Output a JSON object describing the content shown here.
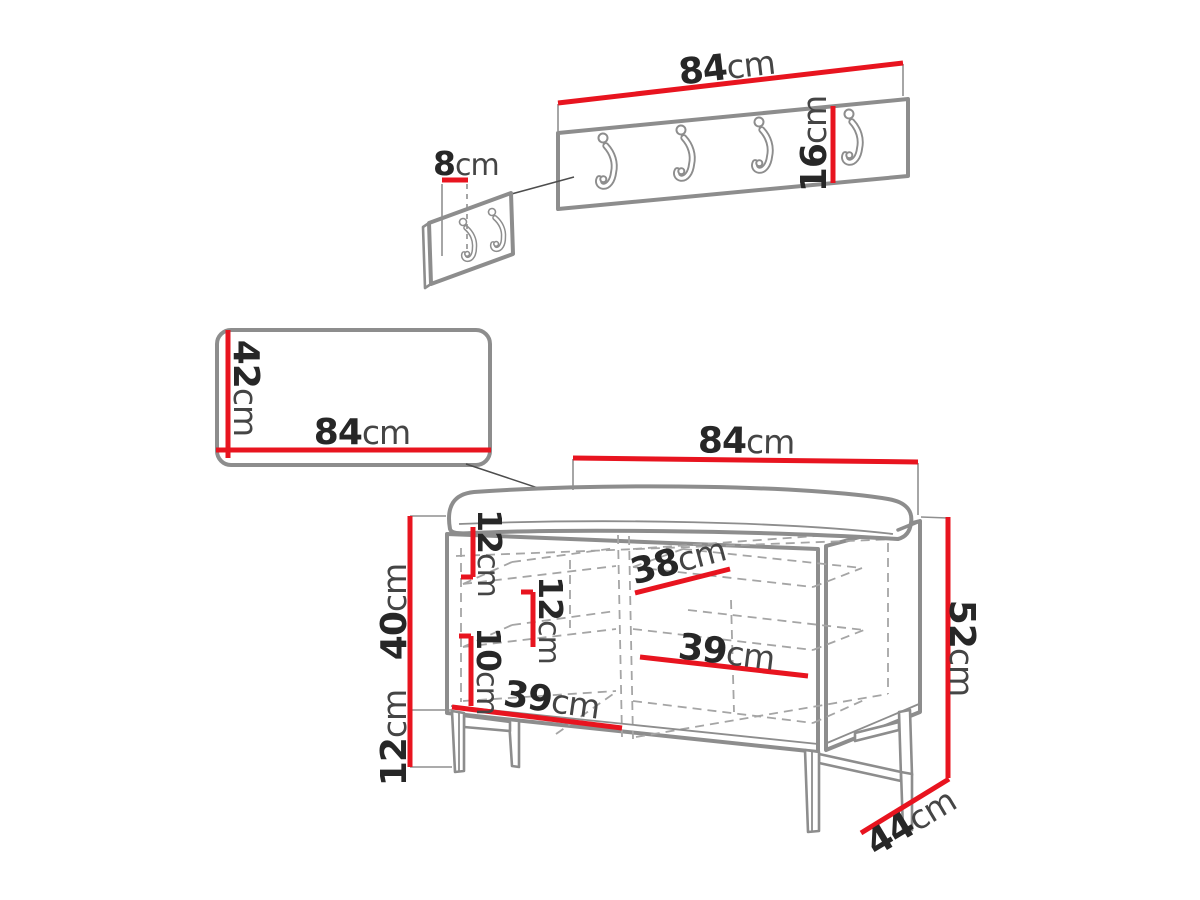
{
  "diagram": {
    "title": "Hallway furniture set dimension drawing",
    "unit": "cm",
    "accent_color": "#e8141f",
    "outline_color": "#8d8d8d",
    "components": {
      "coat_rack": {
        "name": "wall-mounted coat rack panel",
        "hooks_count": 4,
        "width": {
          "value": "84",
          "unit": "cm"
        },
        "height": {
          "value": "16",
          "unit": "cm"
        }
      },
      "hook_detail": {
        "name": "hook spacing detail panel",
        "hooks_count": 2,
        "spacing": {
          "value": "8",
          "unit": "cm"
        }
      },
      "mirror": {
        "name": "wall panel / mirror",
        "height": {
          "value": "42",
          "unit": "cm"
        },
        "width": {
          "value": "84",
          "unit": "cm"
        }
      },
      "bench": {
        "name": "shoe storage bench with cushion",
        "width": {
          "value": "84",
          "unit": "cm"
        },
        "height": {
          "value": "52",
          "unit": "cm"
        },
        "depth": {
          "value": "44",
          "unit": "cm"
        },
        "body_height": {
          "value": "40",
          "unit": "cm"
        },
        "leg_height": {
          "value": "12",
          "unit": "cm"
        },
        "top_gap": {
          "value": "12",
          "unit": "cm"
        },
        "mid_gap": {
          "value": "12",
          "unit": "cm"
        },
        "low_gap": {
          "value": "10",
          "unit": "cm"
        },
        "shelf_top": {
          "value": "38",
          "unit": "cm"
        },
        "shelf_mid": {
          "value": "39",
          "unit": "cm"
        },
        "shelf_bottom": {
          "value": "39",
          "unit": "cm"
        }
      }
    }
  }
}
